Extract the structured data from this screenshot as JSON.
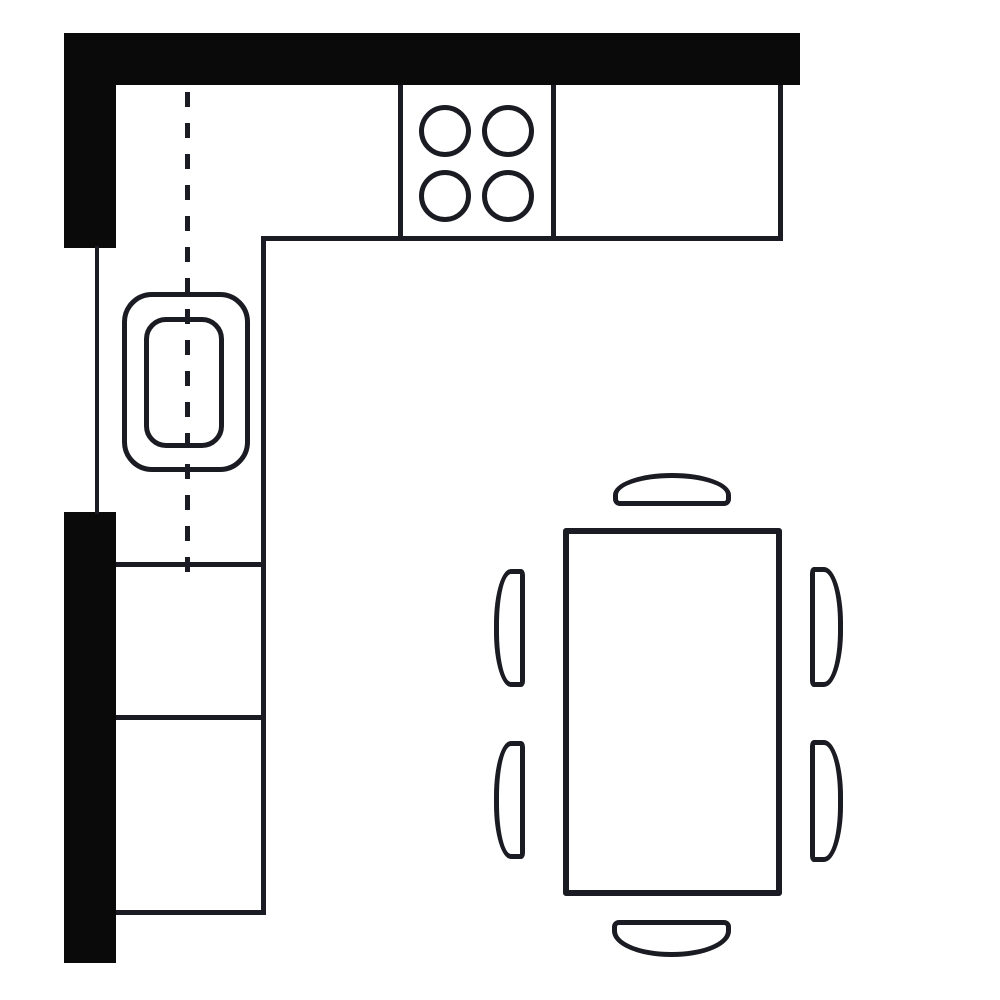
{
  "app": {
    "title": "kitchen-floor-plan-diagram"
  },
  "canvas": {
    "width": 1000,
    "height": 1000,
    "background": "#ffffff",
    "wall_color": "#0a0a0b",
    "line_color": "#1b1b23"
  },
  "floor_plan": {
    "description": "kitchen-with-l-shaped-counter-sink-cooktop-and-dining-table-for-six",
    "shapes": [
      {
        "name": "wall-top",
        "kind": "wall",
        "x": 64,
        "y": 33,
        "w": 736,
        "h": 52
      },
      {
        "name": "wall-left-upper",
        "kind": "wall",
        "x": 64,
        "y": 33,
        "w": 52,
        "h": 215
      },
      {
        "name": "wall-left-lower",
        "kind": "wall",
        "x": 64,
        "y": 512,
        "w": 52,
        "h": 451
      },
      {
        "name": "window-wall-line",
        "kind": "line",
        "x": 95,
        "y": 246,
        "w": 4,
        "h": 268
      },
      {
        "name": "counter-top-right-edge",
        "kind": "line",
        "x": 778,
        "y": 85,
        "w": 5,
        "h": 156
      },
      {
        "name": "counter-top-bottom-edge",
        "kind": "line",
        "x": 261,
        "y": 236,
        "w": 522,
        "h": 5
      },
      {
        "name": "counter-left-right-edge",
        "kind": "line",
        "x": 261,
        "y": 236,
        "w": 5,
        "h": 679
      },
      {
        "name": "counter-left-bottom-edge",
        "kind": "line",
        "x": 116,
        "y": 910,
        "w": 150,
        "h": 5
      },
      {
        "name": "cabinet-divider-upper",
        "kind": "line",
        "x": 116,
        "y": 562,
        "w": 148,
        "h": 5
      },
      {
        "name": "cabinet-divider-lower",
        "kind": "line",
        "x": 116,
        "y": 715,
        "w": 148,
        "h": 5
      },
      {
        "name": "cooktop-left-edge",
        "kind": "line",
        "x": 398,
        "y": 85,
        "w": 5,
        "h": 156
      },
      {
        "name": "cooktop-right-edge",
        "kind": "line",
        "x": 551,
        "y": 85,
        "w": 5,
        "h": 156
      },
      {
        "name": "burner-top-left",
        "kind": "circle-outline",
        "x": 419,
        "y": 105,
        "w": 52,
        "h": 52,
        "t": 5
      },
      {
        "name": "burner-top-right",
        "kind": "circle-outline",
        "x": 482,
        "y": 105,
        "w": 52,
        "h": 52,
        "t": 5
      },
      {
        "name": "burner-bottom-left",
        "kind": "circle-outline",
        "x": 419,
        "y": 170,
        "w": 52,
        "h": 52,
        "t": 5
      },
      {
        "name": "burner-bottom-right",
        "kind": "circle-outline",
        "x": 482,
        "y": 170,
        "w": 52,
        "h": 52,
        "t": 5
      },
      {
        "name": "sink-outer",
        "kind": "round-rect-outline",
        "x": 122,
        "y": 292,
        "w": 128,
        "h": 180,
        "t": 5,
        "radius": "30px"
      },
      {
        "name": "sink-basin",
        "kind": "round-rect-outline",
        "x": 144,
        "y": 317,
        "w": 80,
        "h": 131,
        "t": 5,
        "radius": "22px"
      },
      {
        "name": "sink-center-dashed-line",
        "kind": "dashed-line",
        "x": 185,
        "y": 92,
        "w": 5,
        "h": 482,
        "dash": 15,
        "gap": 16
      },
      {
        "name": "dining-table",
        "kind": "round-rect-outline",
        "x": 563,
        "y": 528,
        "w": 219,
        "h": 368,
        "t": 6,
        "radius": "3px"
      },
      {
        "name": "chair-north",
        "kind": "round-rect-outline",
        "x": 613,
        "y": 473,
        "w": 118,
        "h": 33,
        "t": 5,
        "radius": "59px 59px 7px 7px / 22px 22px 7px 7px"
      },
      {
        "name": "chair-south",
        "kind": "round-rect-outline",
        "x": 612,
        "y": 920,
        "w": 119,
        "h": 37,
        "t": 5,
        "radius": "7px 7px 59px 59px / 7px 7px 26px 26px"
      },
      {
        "name": "chair-west-upper",
        "kind": "round-rect-outline",
        "x": 494,
        "y": 569,
        "w": 31,
        "h": 118,
        "t": 5,
        "radius": "17px 4px 4px 17px / 55px 6px 6px 55px"
      },
      {
        "name": "chair-west-lower",
        "kind": "round-rect-outline",
        "x": 494,
        "y": 741,
        "w": 31,
        "h": 118,
        "t": 5,
        "radius": "17px 4px 4px 17px / 55px 6px 6px 55px"
      },
      {
        "name": "chair-east-upper",
        "kind": "round-rect-outline",
        "x": 810,
        "y": 567,
        "w": 33,
        "h": 120,
        "t": 5,
        "radius": "4px 19px 19px 4px / 6px 56px 56px 6px"
      },
      {
        "name": "chair-east-lower",
        "kind": "round-rect-outline",
        "x": 810,
        "y": 740,
        "w": 33,
        "h": 122,
        "t": 5,
        "radius": "4px 19px 19px 4px / 6px 56px 56px 6px"
      }
    ]
  }
}
